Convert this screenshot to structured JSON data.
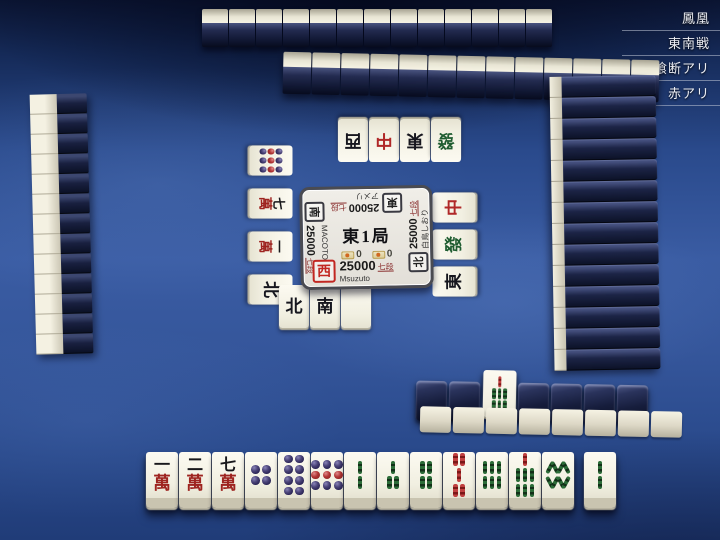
{
  "meta": {
    "lines": [
      "鳳凰",
      "東南戦",
      "喰断アリ",
      "赤アリ"
    ]
  },
  "info_panel": {
    "round": "東1局",
    "riichi_sticks": "0",
    "honba": "0",
    "players": {
      "bottom": {
        "wind": "西",
        "score": "25000",
        "rank": "七段",
        "name": "Msuzuto"
      },
      "left": {
        "wind": "南",
        "score": "25000",
        "rank": "七段",
        "name": "MACOTO"
      },
      "top": {
        "wind": "東",
        "score": "25000",
        "rank": "七段",
        "name": "アメリ"
      },
      "right": {
        "wind": "北",
        "score": "25000",
        "rank": "七段",
        "name": "白鳥しおり"
      }
    }
  },
  "hand": {
    "tiles": [
      "1m",
      "2m",
      "7m",
      "4p",
      "8p",
      "9p",
      "2s",
      "3s",
      "4s",
      "0s",
      "6s",
      "7s",
      "8s"
    ],
    "drawn": [
      "2s"
    ]
  },
  "discards": {
    "bottom": [
      "N",
      "S",
      "P"
    ],
    "top": [
      "W",
      "C",
      "E",
      "F"
    ],
    "left": [
      "9p",
      "7m",
      "1m",
      "N"
    ],
    "right": [
      "C",
      "F",
      "E"
    ]
  },
  "dead_wall": {
    "dora": [
      "7s"
    ]
  },
  "walls": {
    "top_far": 13,
    "top_near": 13,
    "left": 13,
    "right": 14,
    "dead_upper_left": 2,
    "dead_upper_right": 4,
    "dead_lower": 8
  }
}
